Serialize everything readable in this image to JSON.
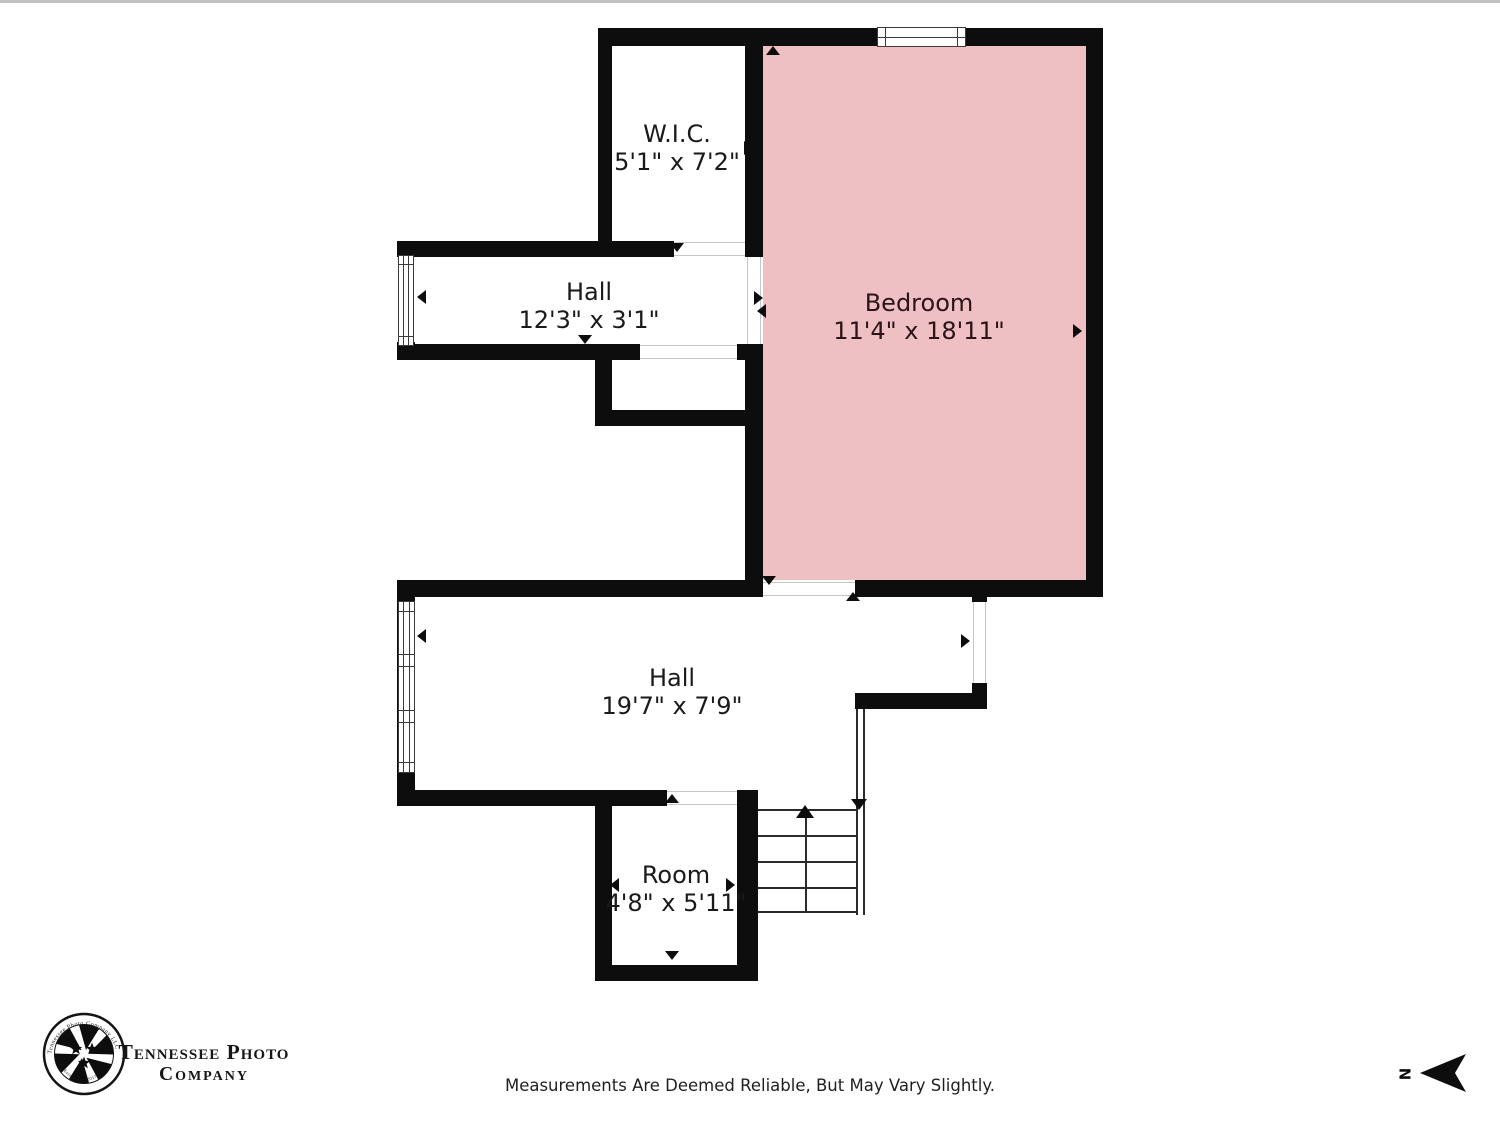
{
  "page": {
    "background": "#ffffff"
  },
  "colors": {
    "wall": "#0d0d0d",
    "bedroom_fill": "#efc0c3",
    "window_frame": "#3a3a3a",
    "stair_line": "#2b2b2b",
    "label_text": "#1a1a1a",
    "bedroom_label_text": "#2a1417"
  },
  "rooms": {
    "wic": {
      "name": "W.I.C.",
      "dims": "5'1\" x 7'2\""
    },
    "hall_upper": {
      "name": "Hall",
      "dims": "12'3\" x 3'1\""
    },
    "bedroom": {
      "name": "Bedroom",
      "dims": "11'4\" x 18'11\""
    },
    "hall_lower": {
      "name": "Hall",
      "dims": "19'7\" x 7'9\""
    },
    "room": {
      "name": "Room",
      "dims": "4'8\" x 5'11\""
    }
  },
  "footer": {
    "disclaimer": "Measurements Are Deemed Reliable, But May Vary Slightly."
  },
  "logo": {
    "wordmark_line1": "Tennessee Photo",
    "wordmark_line2": "Company",
    "ring_top": "Tennessee Photo Company LLC",
    "ring_bottom": "Established 2017"
  },
  "compass": {
    "north_label": "N"
  }
}
